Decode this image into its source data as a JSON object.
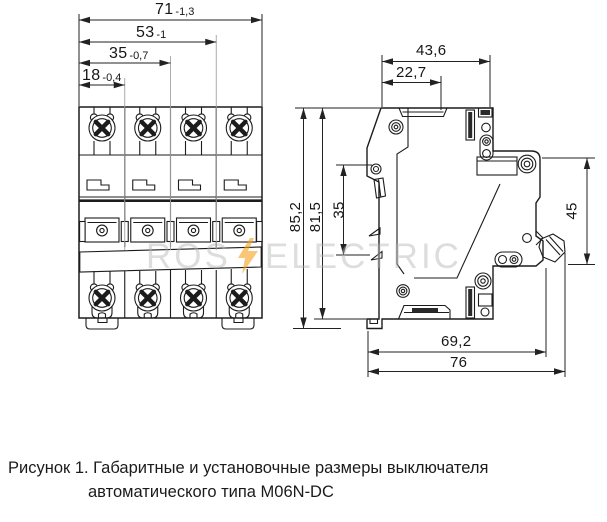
{
  "watermark": {
    "text_left": "ROS",
    "text_right": "ELECTRIC",
    "bolt_color": "#f6a21c",
    "text_color": "#c8c8c8"
  },
  "front_view": {
    "dims": [
      {
        "value": "71",
        "tol": "-1,3"
      },
      {
        "value": "53",
        "tol": "-1"
      },
      {
        "value": "35",
        "tol": "-0,7"
      },
      {
        "value": "18",
        "tol": "-0,4"
      }
    ]
  },
  "side_view": {
    "dim_width_top": "43,6",
    "dim_width_toggle": "22,7",
    "dim_height_total": "85,2",
    "dim_height_body": "81,5",
    "dim_toggle_window": "35",
    "dim_din_flange": "45",
    "dim_depth_inner": "69,2",
    "dim_depth_total": "76"
  },
  "caption": {
    "line1": "Рисунок 1. Габаритные и установочные размеры выключателя",
    "line2": "автоматического типа М06N-DC"
  }
}
